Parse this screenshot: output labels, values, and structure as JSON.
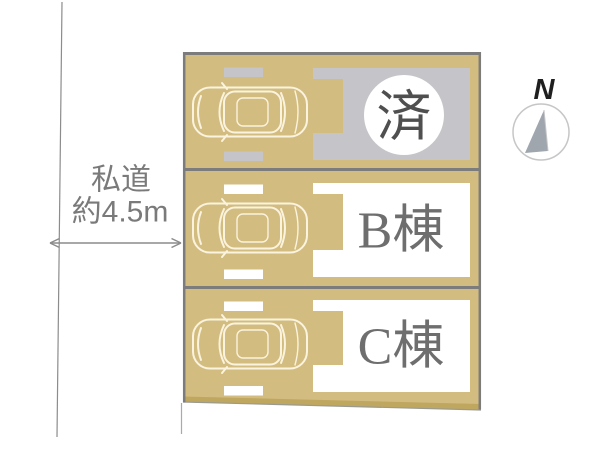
{
  "diagram": {
    "road_label": {
      "line1": "私道",
      "line2": "約4.5m"
    },
    "compass": {
      "label": "N"
    },
    "parcels": [
      {
        "id": "sold",
        "label": "済",
        "status": "sold"
      },
      {
        "id": "b",
        "label": "B棟",
        "status": "available"
      },
      {
        "id": "c",
        "label": "C棟",
        "status": "available"
      }
    ],
    "colors": {
      "parcel_fill": "#d3bc80",
      "parcel_bottom_band": "#bfa75f",
      "border": "#7c7c7c",
      "sold_footprint": "#c5c5c9",
      "available_footprint": "#ffffff",
      "sold_badge_bg": "#ffffff",
      "sold_text": "#4f4f4f",
      "label_text": "#6e6e6e",
      "road_text": "#7a7a7a",
      "road_line": "#8c8c8c",
      "compass_needle": "#9fa6ae",
      "compass_ring": "#c6c6c6",
      "compass_text": "#1f1f1f",
      "car_outline": "#faf3de"
    }
  }
}
